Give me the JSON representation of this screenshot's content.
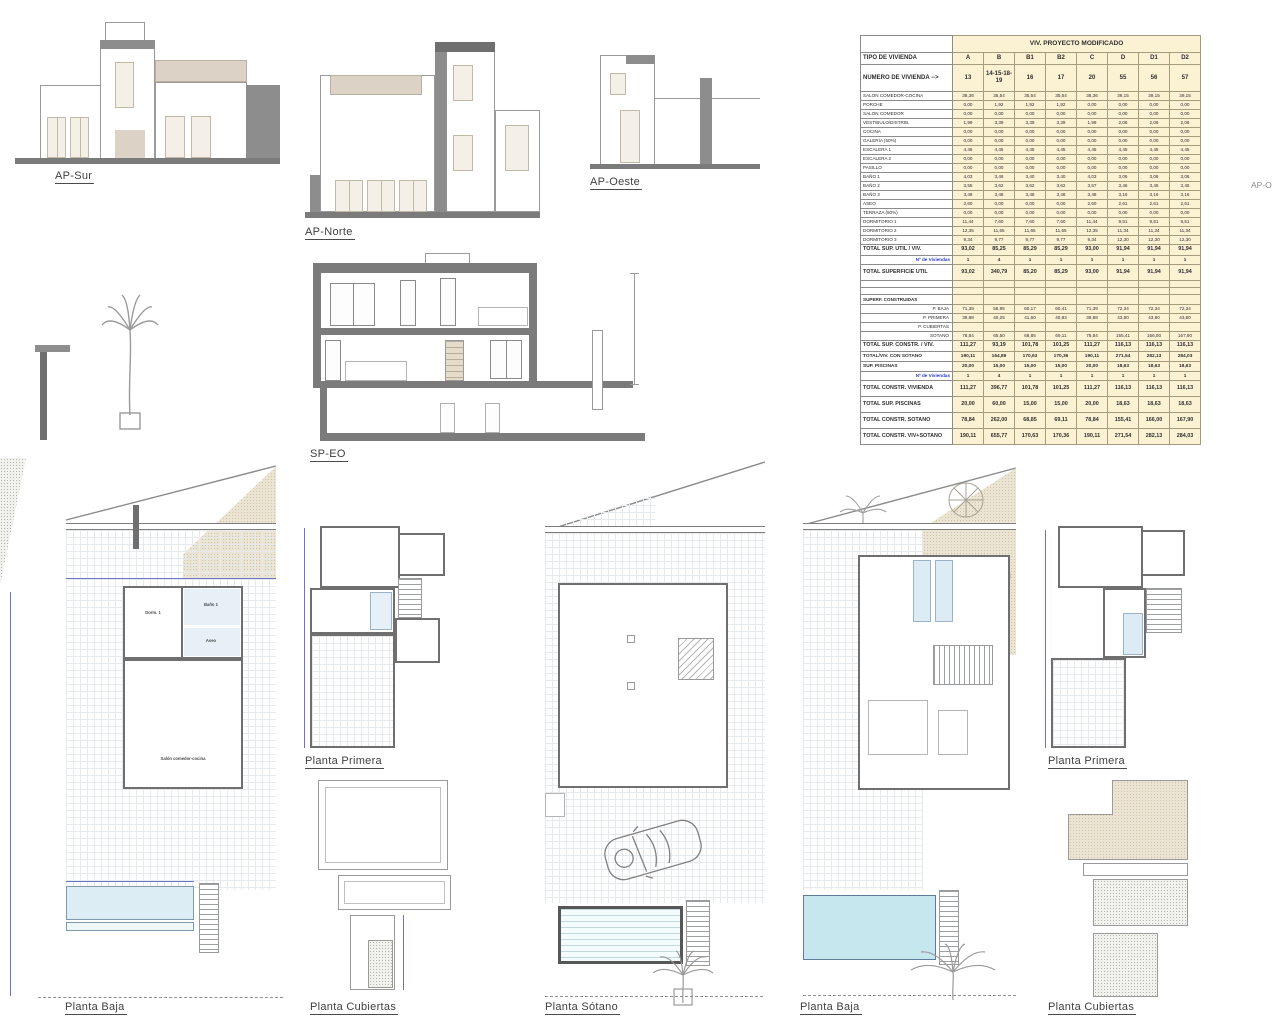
{
  "labels": {
    "ap_sur": "AP-Sur",
    "ap_norte": "AP-Norte",
    "ap_oeste": "AP-Oeste",
    "ap_oeste_partial": "AP-O",
    "sp_eo": "SP-EO",
    "planta_baja_1": "Planta Baja",
    "planta_primera_1": "Planta Primera",
    "planta_cubiertas_1": "Planta Cubiertas",
    "planta_sotano": "Planta Sótano",
    "planta_baja_2": "Planta Baja",
    "planta_primera_2": "Planta Primera",
    "planta_cubiertas_2": "Planta Cubiertas"
  },
  "rooms": {
    "dorm1": "Dorm. 1",
    "bano1": "Baño 1",
    "aseo": "Aseo",
    "salon": "Salón comedor-cocina"
  },
  "colors": {
    "table_fill": "#fbf1d3",
    "dim_blue": "#6b74c9",
    "slab_gray": "#7b7b7b",
    "terrain_tan": "#ebe4d2",
    "pool_blue": "#c7e7ee"
  },
  "table": {
    "title": "VIV. PROYECTO MODIFICADO",
    "tipo_label": "TIPO DE VIVIENDA",
    "numero_label": "NUMERO DE VIVIENDA -->",
    "columns": [
      "A",
      "B",
      "B1",
      "B2",
      "C",
      "D",
      "D1",
      "D2"
    ],
    "numeros": [
      "13",
      "14-15-18-19",
      "16",
      "17",
      "20",
      "55",
      "56",
      "57"
    ],
    "rows": [
      {
        "label": "SALON COMEDOR-COCINA",
        "cls": "n",
        "values": [
          "38,36",
          "35,54",
          "35,54",
          "35,54",
          "38,36",
          "39,15",
          "39,15",
          "39,15"
        ]
      },
      {
        "label": "PORCHE",
        "cls": "n",
        "values": [
          "0,00",
          "1,92",
          "1,92",
          "1,92",
          "0,00",
          "0,00",
          "0,00",
          "0,00"
        ]
      },
      {
        "label": "SALON COMEDOR",
        "cls": "n",
        "values": [
          "0,00",
          "0,00",
          "0,00",
          "0,00",
          "0,00",
          "0,00",
          "0,00",
          "0,00"
        ]
      },
      {
        "label": "VESTIBULO/DISTRIB.",
        "cls": "n",
        "values": [
          "1,99",
          "3,39",
          "3,39",
          "3,39",
          "1,99",
          "2,06",
          "2,06",
          "2,06"
        ]
      },
      {
        "label": "COCINA",
        "cls": "n",
        "values": [
          "0,00",
          "0,00",
          "0,00",
          "0,00",
          "0,00",
          "0,00",
          "0,00",
          "0,00"
        ]
      },
      {
        "label": "GALERIA (50%)",
        "cls": "n",
        "values": [
          "0,00",
          "0,00",
          "0,00",
          "0,00",
          "0,00",
          "0,00",
          "0,00",
          "0,00"
        ]
      },
      {
        "label": "ESCALERA 1",
        "cls": "n",
        "values": [
          "4,45",
          "4,45",
          "4,45",
          "4,45",
          "4,45",
          "4,45",
          "4,45",
          "4,45"
        ]
      },
      {
        "label": "ESCALERA 2",
        "cls": "n",
        "values": [
          "0,00",
          "0,00",
          "0,00",
          "0,00",
          "0,00",
          "0,00",
          "0,00",
          "0,00"
        ]
      },
      {
        "label": "PASILLO",
        "cls": "n",
        "values": [
          "0,00",
          "0,00",
          "0,00",
          "0,00",
          "0,00",
          "0,00",
          "0,00",
          "0,00"
        ]
      },
      {
        "label": "BAÑO 1",
        "cls": "n",
        "values": [
          "4,03",
          "3,46",
          "3,40",
          "3,40",
          "4,03",
          "3,06",
          "3,06",
          "3,06"
        ]
      },
      {
        "label": "BAÑO 2",
        "cls": "n",
        "values": [
          "3,55",
          "3,62",
          "3,62",
          "3,62",
          "3,57",
          "3,46",
          "3,46",
          "3,46"
        ]
      },
      {
        "label": "BAÑO 3",
        "cls": "n",
        "values": [
          "3,48",
          "3,48",
          "3,48",
          "3,48",
          "3,48",
          "3,16",
          "3,16",
          "3,16"
        ]
      },
      {
        "label": "ASEO",
        "cls": "n",
        "values": [
          "2,60",
          "0,00",
          "0,00",
          "0,00",
          "2,60",
          "2,61",
          "2,61",
          "2,61"
        ]
      },
      {
        "label": "TERRAZA (50%)",
        "cls": "n",
        "values": [
          "0,00",
          "0,00",
          "0,00",
          "0,00",
          "0,00",
          "0,00",
          "0,00",
          "0,00"
        ]
      },
      {
        "label": "DORMITORIO 1",
        "cls": "n",
        "values": [
          "11,44",
          "7,60",
          "7,60",
          "7,60",
          "11,44",
          "9,51",
          "9,51",
          "9,51"
        ]
      },
      {
        "label": "DORMITORIO 2",
        "cls": "n",
        "values": [
          "12,35",
          "11,65",
          "11,65",
          "11,65",
          "12,35",
          "11,34",
          "11,34",
          "11,34"
        ]
      },
      {
        "label": "DORMITORIO 3",
        "cls": "n",
        "values": [
          "9,34",
          "9,77",
          "9,77",
          "9,77",
          "9,34",
          "12,30",
          "12,30",
          "12,30"
        ]
      },
      {
        "label": "TOTAL SUP. UTIL / VIV.",
        "cls": "total",
        "values": [
          "93,02",
          "85,25",
          "85,29",
          "85,29",
          "93,00",
          "91,94",
          "91,94",
          "91,94"
        ]
      },
      {
        "label": "Nº de Viviendas",
        "cls": "viv",
        "values": [
          "1",
          "4",
          "1",
          "1",
          "1",
          "1",
          "1",
          "1"
        ]
      },
      {
        "label": "TOTAL SUPERFICIE UTIL",
        "cls": "total tall",
        "values": [
          "93,02",
          "340,79",
          "85,20",
          "85,29",
          "93,00",
          "91,94",
          "91,94",
          "91,94"
        ]
      },
      {
        "label": "",
        "cls": "empty",
        "values": [
          "",
          "",
          "",
          "",
          "",
          "",
          "",
          ""
        ]
      },
      {
        "label": "",
        "cls": "empty",
        "values": [
          "",
          "",
          "",
          "",
          "",
          "",
          "",
          ""
        ]
      },
      {
        "label": "SUPERF. CONSTRUIDAS",
        "cls": "section",
        "values": [
          "",
          "",
          "",
          "",
          "",
          "",
          "",
          ""
        ]
      },
      {
        "label": "P. BAJA",
        "cls": "sub",
        "values": [
          "71,39",
          "56,95",
          "60,17",
          "60,41",
          "71,39",
          "72,34",
          "72,34",
          "72,34"
        ]
      },
      {
        "label": "P. PRIMERA",
        "cls": "sub",
        "values": [
          "39,88",
          "40,25",
          "41,60",
          "40,83",
          "39,88",
          "43,80",
          "43,80",
          "43,80"
        ]
      },
      {
        "label": "P. CUBIERTAS",
        "cls": "sub",
        "values": [
          "",
          "",
          "",
          "",
          "",
          "",
          "",
          ""
        ]
      },
      {
        "label": "SOTANO",
        "cls": "sub",
        "values": [
          "78,84",
          "65,50",
          "68,85",
          "69,11",
          "78,84",
          "155,41",
          "166,00",
          "167,90"
        ]
      },
      {
        "label": "TOTAL SUP. CONSTR. / VIV.",
        "cls": "total",
        "values": [
          "111,27",
          "93,19",
          "101,78",
          "101,25",
          "111,27",
          "116,13",
          "116,13",
          "116,13"
        ]
      },
      {
        "label": "TOTAL/VIV. CON SOTANO",
        "cls": "totalsm",
        "values": [
          "190,11",
          "164,89",
          "170,63",
          "170,36",
          "190,11",
          "271,54",
          "282,13",
          "284,03"
        ]
      },
      {
        "label": "SUP. PISCINAS",
        "cls": "totalsm",
        "values": [
          "20,00",
          "15,00",
          "15,00",
          "15,00",
          "20,00",
          "18,63",
          "18,63",
          "18,63"
        ]
      },
      {
        "label": "Nº de Viviendas",
        "cls": "viv",
        "values": [
          "1",
          "4",
          "1",
          "1",
          "1",
          "1",
          "1",
          "1"
        ]
      },
      {
        "label": "TOTAL CONSTR. VIVIENDA",
        "cls": "total tall",
        "values": [
          "111,27",
          "396,77",
          "101,78",
          "101,25",
          "111,27",
          "116,13",
          "116,13",
          "116,13"
        ]
      },
      {
        "label": "TOTAL SUP. PISCINAS",
        "cls": "total tall",
        "values": [
          "20,00",
          "60,00",
          "15,00",
          "15,00",
          "20,00",
          "18,63",
          "18,63",
          "18,63"
        ]
      },
      {
        "label": "TOTAL CONSTR. SOTANO",
        "cls": "total tall",
        "values": [
          "78,84",
          "262,00",
          "68,85",
          "69,11",
          "78,84",
          "155,41",
          "166,00",
          "167,90"
        ]
      },
      {
        "label": "TOTAL CONSTR. VIV+SOTANO",
        "cls": "total tall",
        "values": [
          "190,11",
          "655,77",
          "170,63",
          "170,36",
          "190,11",
          "271,54",
          "282,13",
          "284,03"
        ]
      }
    ]
  }
}
